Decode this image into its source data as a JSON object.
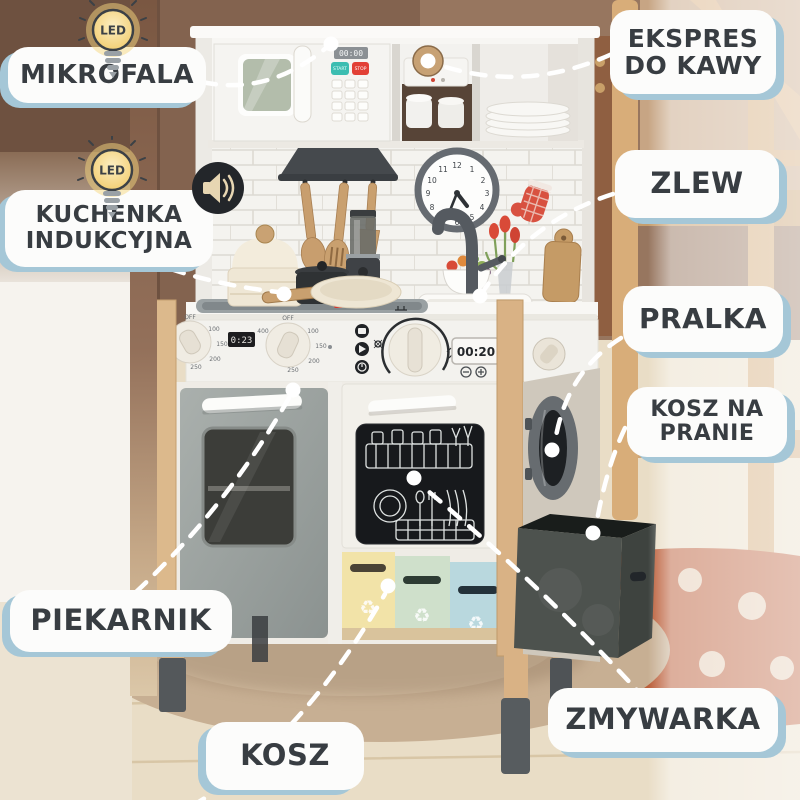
{
  "scene": {
    "description": "Wooden toy play kitchen in a child's room with Polish feature callouts",
    "colors": {
      "label_bg": "#fcfcfb",
      "label_text": "#383d42",
      "label_shadow": "#a5c7d7",
      "dash_line": "#ffffff",
      "wall_brown": "#6e5140",
      "wood_frame": "#d9b285",
      "oven_gray": "#9aa3a0",
      "dishwasher_panel": "#17191c",
      "bin_yellow": "#f2e3a8",
      "bin_green": "#cfe0cb",
      "bin_blue": "#b9d8de",
      "rug_beige": "#c7af93",
      "rug_terracotta": "#bb5e39",
      "floor_wood": "#e9ddc6",
      "accent_teal": "#3cbdb1",
      "accent_red": "#e24036"
    }
  },
  "badges": {
    "led": "LED"
  },
  "callouts": {
    "mikrofala": {
      "label": "MIKROFALA"
    },
    "ekspres_do_kawy": {
      "line1": "EKSPRES",
      "line2": "DO KAWY"
    },
    "zlew": {
      "label": "ZLEW"
    },
    "kuchenka_indukcyjna": {
      "line1": "KUCHENKA",
      "line2": "INDUKCYJNA"
    },
    "pralka": {
      "label": "PRALKA"
    },
    "kosz_na_pranie": {
      "line1": "KOSZ NA",
      "line2": "PRANIE"
    },
    "piekarnik": {
      "label": "PIEKARNIK"
    },
    "kosz": {
      "label": "KOSZ"
    },
    "zmywarka": {
      "label": "ZMYWARKA"
    }
  },
  "appliance": {
    "microwave_display": "00:00",
    "microwave_start": "START",
    "microwave_stop": "STOP",
    "oven_timer": "0:23",
    "kitchen_timer": "00:20",
    "dial_off": "OFF",
    "dial_numbers": [
      "400",
      "100",
      "150",
      "200",
      "250"
    ],
    "clock_numbers": [
      "12",
      "1",
      "2",
      "3",
      "4",
      "5",
      "6",
      "7",
      "8",
      "9",
      "10",
      "11"
    ],
    "recycle_symbol": "♻"
  }
}
